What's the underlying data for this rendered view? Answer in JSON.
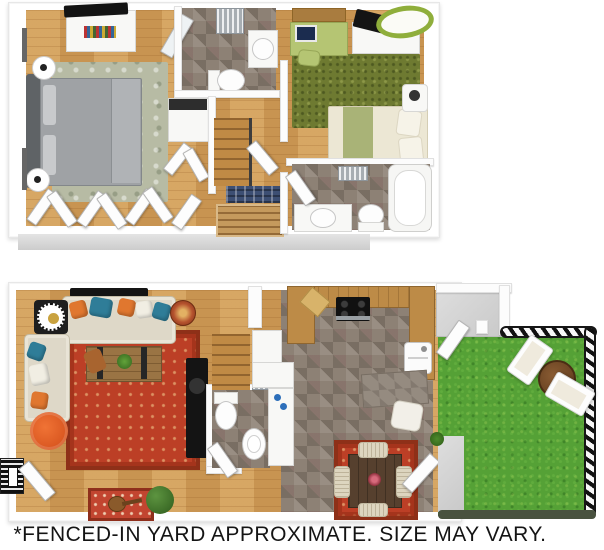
{
  "caption": {
    "text": "*FENCED-IN YARD APPROXIMATE. SIZE MAY VARY."
  },
  "palette": {
    "wall": "#ffffff",
    "wood_floor": "#cf9b57",
    "bath_kitchen_tile": "#8d8175",
    "grass": "#55a136",
    "fence": "#161616",
    "rug_red": "#bc3f26",
    "rug_sage": "#b7bba4",
    "rug_olive_shag": "#6e7a31",
    "accent_orange": "#e0772f",
    "accent_teal": "#2f7d98",
    "desk_green": "#b5c573",
    "counter_wood": "#bd8b47"
  },
  "plan": {
    "second_floor": {
      "rooms": [
        "master-bedroom",
        "closet",
        "bathroom",
        "laundry-closet",
        "hallway-stairs",
        "bedroom-2",
        "bathroom-2"
      ]
    },
    "first_floor": {
      "rooms": [
        "living-room",
        "entry",
        "powder-room",
        "stairs",
        "kitchen",
        "dining-area",
        "patio",
        "fenced-in-yard"
      ]
    }
  }
}
